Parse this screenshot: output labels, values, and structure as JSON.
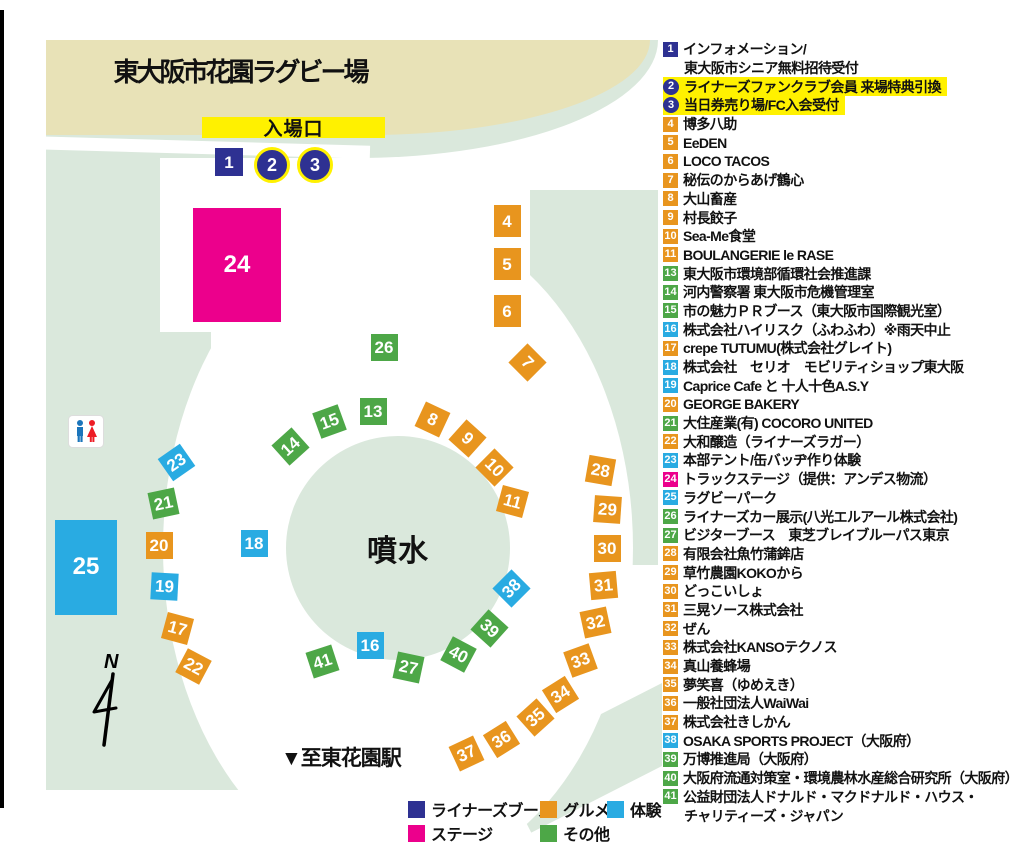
{
  "page": {
    "title": "東大阪市花園ラグビー場",
    "entrance_label": "入場口",
    "fountain_label": "噴水",
    "station_label": "▼至東花園駅",
    "north_label": "N"
  },
  "colors": {
    "liners": "#2E3192",
    "stage": "#EC008C",
    "gourmet": "#E8951E",
    "other": "#4DA747",
    "taiken": "#29ABE2",
    "highlight": "#FFF100",
    "tan": "#E8E2B7",
    "grass": "#DAE8DC"
  },
  "legend": [
    {
      "label": "ライナーズブース",
      "category": "liners"
    },
    {
      "label": "ステージ",
      "category": "stage"
    },
    {
      "label": "グルメ",
      "category": "gourmet"
    },
    {
      "label": "その他",
      "category": "other"
    },
    {
      "label": "体験",
      "category": "taiken"
    }
  ],
  "booths": [
    {
      "id": 1,
      "name": "インフォメーション/",
      "name2": "東大阪市シニア無料招待受付",
      "category": "liners"
    },
    {
      "id": 2,
      "name": "ライナーズファンクラブ会員 来場特典引換",
      "category": "liners",
      "badge": "circle",
      "highlight": true
    },
    {
      "id": 3,
      "name": "当日券売り場/FC入会受付",
      "category": "liners",
      "badge": "circle",
      "highlight": true
    },
    {
      "id": 4,
      "name": "博多八助",
      "category": "gourmet"
    },
    {
      "id": 5,
      "name": "EeDEN",
      "category": "gourmet"
    },
    {
      "id": 6,
      "name": "LOCO TACOS",
      "category": "gourmet"
    },
    {
      "id": 7,
      "name": "秘伝のからあげ鶴心",
      "category": "gourmet"
    },
    {
      "id": 8,
      "name": "大山畜産",
      "category": "gourmet"
    },
    {
      "id": 9,
      "name": "村長餃子",
      "category": "gourmet"
    },
    {
      "id": 10,
      "name": "Sea-Me食堂",
      "category": "gourmet"
    },
    {
      "id": 11,
      "name": "BOULANGERIE le RASE",
      "category": "gourmet"
    },
    {
      "id": 13,
      "name": "東大阪市環境部循環社会推進課",
      "category": "other"
    },
    {
      "id": 14,
      "name": "河内警察署 東大阪市危機管理室",
      "category": "other"
    },
    {
      "id": 15,
      "name": "市の魅力ＰＲブース（東大阪市国際観光室）",
      "category": "other"
    },
    {
      "id": 16,
      "name": "株式会社ハイリスク（ふわふわ）※雨天中止",
      "category": "taiken"
    },
    {
      "id": 17,
      "name": "crepe TUTUMU(株式会社グレイト)",
      "category": "gourmet"
    },
    {
      "id": 18,
      "name": "株式会社　セリオ　モビリティショップ東大阪",
      "category": "taiken"
    },
    {
      "id": 19,
      "name": "Caprice Cafe と 十人十色A.S.Y",
      "category": "taiken"
    },
    {
      "id": 20,
      "name": "GEORGE BAKERY",
      "category": "gourmet"
    },
    {
      "id": 21,
      "name": "大住産業(有) COCORO UNITED",
      "category": "other"
    },
    {
      "id": 22,
      "name": "大和醸造（ライナーズラガー）",
      "category": "gourmet"
    },
    {
      "id": 23,
      "name": "本部テント/缶バッヂ作り体験",
      "category": "taiken"
    },
    {
      "id": 24,
      "name": "トラックステージ（提供：アンデス物流）",
      "category": "stage"
    },
    {
      "id": 25,
      "name": "ラグビーパーク",
      "category": "taiken"
    },
    {
      "id": 26,
      "name": "ライナーズカー展示(八光エルアール株式会社)",
      "category": "other"
    },
    {
      "id": 27,
      "name": "ビジターブース　東芝ブレイブルーパス東京",
      "category": "other"
    },
    {
      "id": 28,
      "name": "有限会社魚竹蒲鉾店",
      "category": "gourmet"
    },
    {
      "id": 29,
      "name": "草竹農園KOKOから",
      "category": "gourmet"
    },
    {
      "id": 30,
      "name": "どっこいしょ",
      "category": "gourmet"
    },
    {
      "id": 31,
      "name": "三晃ソース株式会社",
      "category": "gourmet"
    },
    {
      "id": 32,
      "name": "ぜん",
      "category": "gourmet"
    },
    {
      "id": 33,
      "name": "株式会社KANSOテクノス",
      "category": "gourmet"
    },
    {
      "id": 34,
      "name": "真山養蜂場",
      "category": "gourmet"
    },
    {
      "id": 35,
      "name": "夢笑喜（ゆめえき）",
      "category": "gourmet"
    },
    {
      "id": 36,
      "name": "一般社団法人WaiWai",
      "category": "gourmet"
    },
    {
      "id": 37,
      "name": "株式会社きしかん",
      "category": "gourmet"
    },
    {
      "id": 38,
      "name": "OSAKA SPORTS PROJECT（大阪府）",
      "category": "taiken"
    },
    {
      "id": 39,
      "name": "万博推進局（大阪府）",
      "category": "other"
    },
    {
      "id": 40,
      "name": "大阪府流通対策室・環境農林水産総合研究所（大阪府）",
      "category": "other"
    },
    {
      "id": 41,
      "name": "公益財団法人ドナルド・マクドナルド・ハウス・",
      "name2": "チャリティーズ・ジャパン",
      "category": "other"
    }
  ],
  "map_markers": [
    {
      "n": 1,
      "x": 229,
      "y": 162,
      "w": 28,
      "h": 28
    },
    {
      "n": 2,
      "x": 269,
      "y": 162,
      "shape": "circle",
      "w": 30,
      "h": 30
    },
    {
      "n": 3,
      "x": 312,
      "y": 162,
      "shape": "circle",
      "w": 30,
      "h": 30
    },
    {
      "n": 4,
      "x": 507,
      "y": 221,
      "w": 27,
      "h": 32
    },
    {
      "n": 5,
      "x": 507,
      "y": 264,
      "w": 27,
      "h": 32
    },
    {
      "n": 6,
      "x": 507,
      "y": 311,
      "w": 27,
      "h": 32
    },
    {
      "n": 7,
      "x": 527,
      "y": 362,
      "rot": 45
    },
    {
      "n": 8,
      "x": 432,
      "y": 419,
      "rot": 25
    },
    {
      "n": 9,
      "x": 467,
      "y": 438,
      "rot": 42
    },
    {
      "n": 10,
      "x": 494,
      "y": 467,
      "rot": 45
    },
    {
      "n": 11,
      "x": 512,
      "y": 501,
      "rot": 15
    },
    {
      "n": 13,
      "x": 373,
      "y": 411
    },
    {
      "n": 14,
      "x": 290,
      "y": 446,
      "rot": -42
    },
    {
      "n": 15,
      "x": 329,
      "y": 421,
      "rot": -20
    },
    {
      "n": 16,
      "x": 370,
      "y": 645
    },
    {
      "n": 17,
      "x": 177,
      "y": 628,
      "rot": 15
    },
    {
      "n": 18,
      "x": 254,
      "y": 543
    },
    {
      "n": 19,
      "x": 164,
      "y": 586,
      "rot": 3
    },
    {
      "n": 20,
      "x": 159,
      "y": 545
    },
    {
      "n": 21,
      "x": 163,
      "y": 503,
      "rot": -12
    },
    {
      "n": 22,
      "x": 193,
      "y": 666,
      "rot": 28
    },
    {
      "n": 23,
      "x": 176,
      "y": 462,
      "rot": -35
    },
    {
      "n": 24,
      "x": 237,
      "y": 265,
      "shape": "rect",
      "w": 88,
      "h": 114
    },
    {
      "n": 25,
      "x": 86,
      "y": 567,
      "shape": "rect",
      "w": 62,
      "h": 95
    },
    {
      "n": 26,
      "x": 384,
      "y": 347
    },
    {
      "n": 27,
      "x": 408,
      "y": 667,
      "rot": 12
    },
    {
      "n": 28,
      "x": 600,
      "y": 470,
      "rot": 10
    },
    {
      "n": 29,
      "x": 607,
      "y": 509,
      "rot": 4
    },
    {
      "n": 30,
      "x": 607,
      "y": 548
    },
    {
      "n": 31,
      "x": 603,
      "y": 585,
      "rot": -5
    },
    {
      "n": 32,
      "x": 595,
      "y": 622,
      "rot": -12
    },
    {
      "n": 33,
      "x": 580,
      "y": 660,
      "rot": -20
    },
    {
      "n": 34,
      "x": 560,
      "y": 694,
      "rot": -32
    },
    {
      "n": 35,
      "x": 535,
      "y": 717,
      "rot": -42
    },
    {
      "n": 36,
      "x": 501,
      "y": 739,
      "rot": -32
    },
    {
      "n": 37,
      "x": 466,
      "y": 753,
      "rot": -25
    },
    {
      "n": 38,
      "x": 511,
      "y": 588,
      "rot": -45
    },
    {
      "n": 39,
      "x": 489,
      "y": 628,
      "rot": 42
    },
    {
      "n": 40,
      "x": 458,
      "y": 654,
      "rot": 28
    },
    {
      "n": 41,
      "x": 322,
      "y": 661,
      "rot": -18
    }
  ]
}
